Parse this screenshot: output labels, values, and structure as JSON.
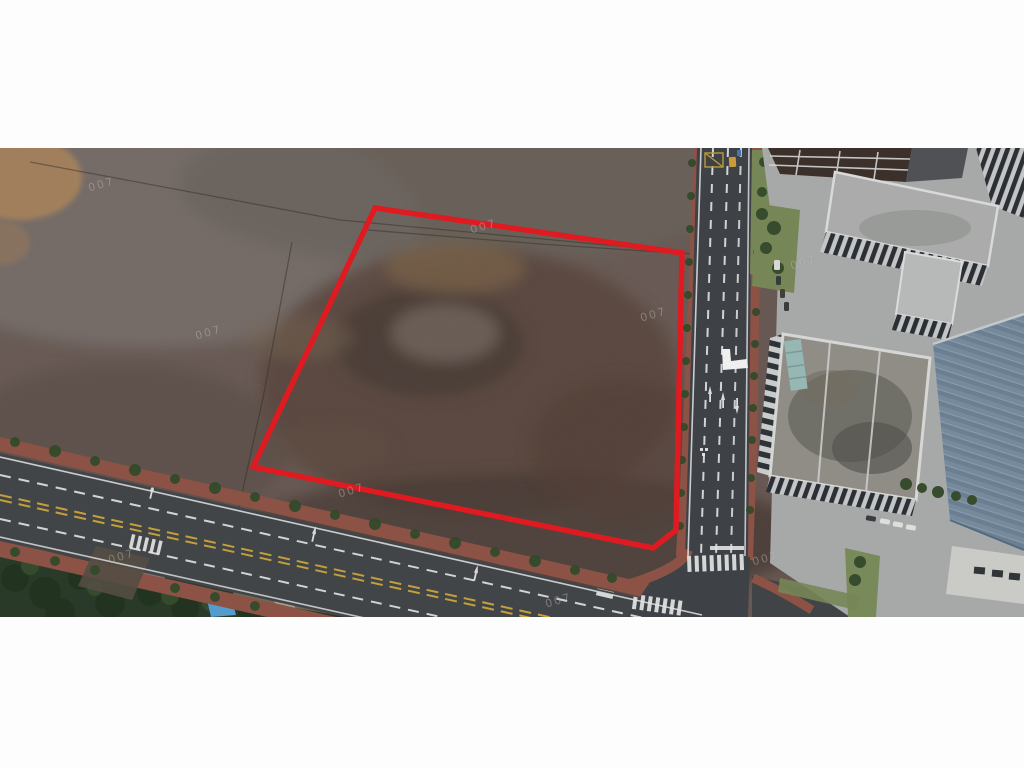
{
  "meta": {
    "type": "letterboxed-aerial-drone-photograph",
    "description": "Aerial photo of a vacant brown dirt land parcel outlined with a red boundary polygon; a multi-lane road runs diagonally along the bottom edge and a second road runs vertically on the right with a crosswalk intersection; industrial/office buildings with gray and blue roofs on the right; dense trees and garden plots in the lower-left; white letterbox bars above and below the photo."
  },
  "letterbox": {
    "color": "#fdfdfd"
  },
  "photo": {
    "parcel_outline": {
      "color": "#ee1b23",
      "points": "375,60 682,105 676,382 653,400 253,319"
    },
    "angle_marker": {
      "color": "#ffffff",
      "points": "722,201 730,201 731,213 747,211 748,220 723,222"
    },
    "watermark": {
      "text": "007",
      "positions": [
        {
          "x": 88,
          "y": 30
        },
        {
          "x": 195,
          "y": 178
        },
        {
          "x": 338,
          "y": 336
        },
        {
          "x": 108,
          "y": 402
        },
        {
          "x": 640,
          "y": 160
        },
        {
          "x": 752,
          "y": 404
        },
        {
          "x": 790,
          "y": 108
        },
        {
          "x": 470,
          "y": 72
        },
        {
          "x": 545,
          "y": 446
        }
      ]
    }
  },
  "colors": {
    "letterbox": "#fdfdfd",
    "field-base": "#6d5e58",
    "field-gray": "#7d7571",
    "parcel-dirt": "#5d483f",
    "road": "#42464a",
    "sidewalk": "#96574a",
    "tree": "#35502d",
    "veg-dark": "#2c3e2b",
    "lawn": "#7d8f5c",
    "concrete": "#b2b5b5",
    "roof-gray": "#a3a4a0",
    "roof-blue": "#7e93a6",
    "parcel-red": "#ee1b23",
    "mark-white": "#f2f3f4",
    "mark-yellow": "#d9b13f",
    "tarp-blue": "#58a7db",
    "watermark": "rgba(235,235,235,0.30)"
  }
}
